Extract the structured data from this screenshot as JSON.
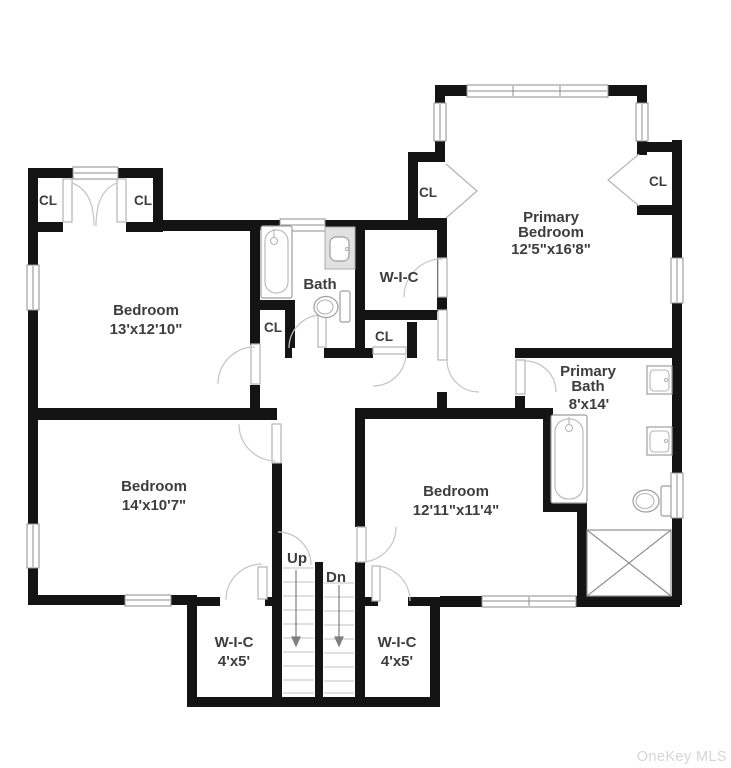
{
  "watermark": "OneKey MLS",
  "colors": {
    "wall": "#141414",
    "text": "#3d3d3d",
    "door_swing": "#c4c4c4",
    "window_frame": "#8e8e8e",
    "watermark": "#d5d5d5",
    "background": "#ffffff"
  },
  "rooms": {
    "bedroom_top_left": {
      "name": "Bedroom",
      "dims": "13'x12'10\""
    },
    "bedroom_bottom_left": {
      "name": "Bedroom",
      "dims": "14'x10'7\""
    },
    "bedroom_bottom_middle": {
      "name": "Bedroom",
      "dims": "12'11\"x11'4\""
    },
    "primary_bedroom": {
      "name_line1": "Primary",
      "name_line2": "Bedroom",
      "dims": "12'5\"x16'8\""
    },
    "primary_bath": {
      "name_line1": "Primary",
      "name_line2": "Bath",
      "dims": "8'x14'"
    },
    "bath": {
      "name": "Bath"
    },
    "wic_center": {
      "name": "W-I-C"
    },
    "wic_bottom_left": {
      "name": "W-I-C",
      "dims": "4'x5'"
    },
    "wic_bottom_right": {
      "name": "W-I-C",
      "dims": "4'x5'"
    }
  },
  "labels": {
    "closet": "CL",
    "stairs_up": "Up",
    "stairs_down": "Dn"
  }
}
